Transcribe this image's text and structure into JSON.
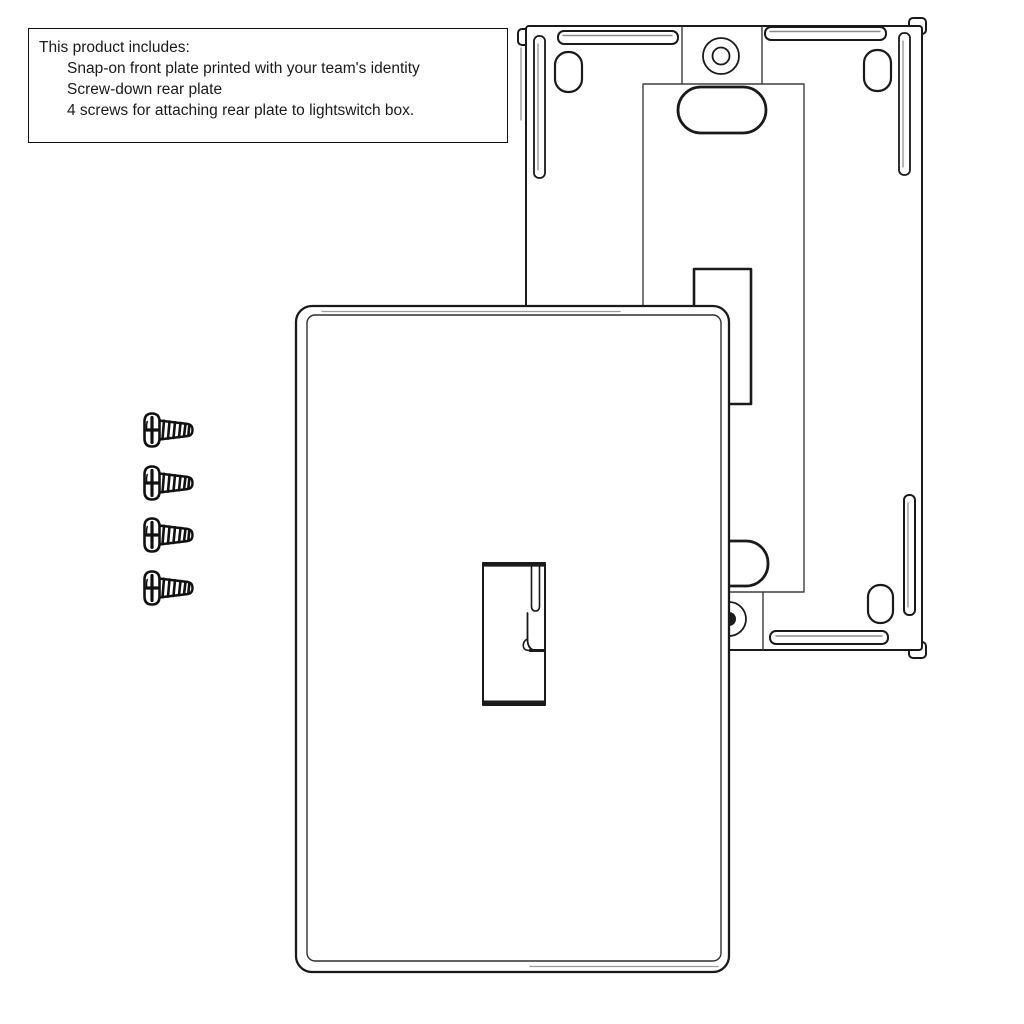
{
  "info_box": {
    "title": "This product includes:",
    "items": [
      "Snap-on front plate printed with your team's identity",
      "Screw-down rear plate",
      "4 screws for attaching rear plate to lightswitch box."
    ]
  },
  "illustration": {
    "screw_count": 4,
    "colors": {
      "line": "#1a1a1a",
      "secondary_line": "#8a8a8a",
      "background": "#ffffff"
    }
  }
}
